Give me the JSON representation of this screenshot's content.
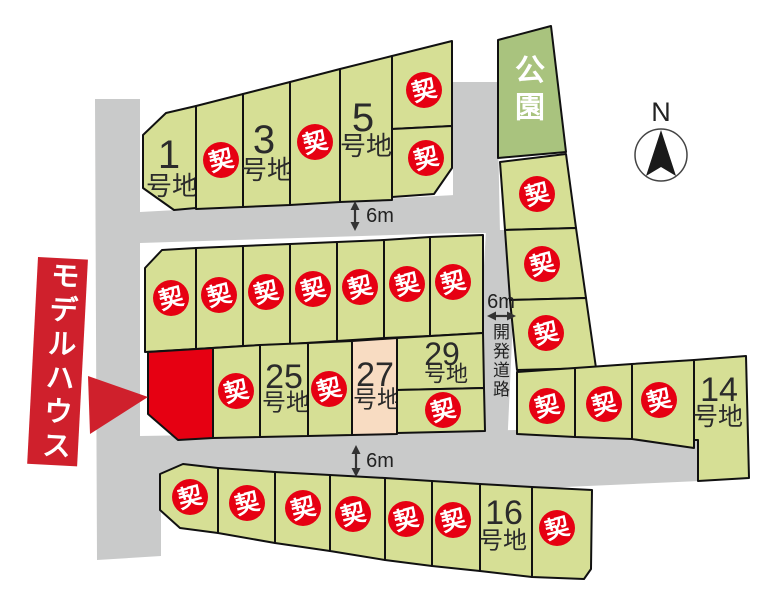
{
  "badge_label": "契",
  "park": {
    "label": "公園"
  },
  "road": {
    "label": "開発道路"
  },
  "model_house": {
    "label": "モデルハウス"
  },
  "north": {
    "label": "N"
  },
  "dims": [
    "6m",
    "6m",
    "6m"
  ],
  "colors": {
    "lot_green": "#d6df95",
    "park_green": "#a9c37e",
    "reserved_pink": "#f8dcc2",
    "sold_red": "#e60012",
    "model_red": "#e60012",
    "banner_red": "#cf202c",
    "road_gray": "#c9caca",
    "line_dark": "#111111",
    "text_dark": "#2b2b2b",
    "dim_color": "#333333"
  },
  "lots": [
    {
      "id": "t1",
      "number": "1",
      "suffix": "号地",
      "status": "available"
    },
    {
      "id": "t2",
      "status": "sold"
    },
    {
      "id": "t3",
      "number": "3",
      "suffix": "号地",
      "status": "available"
    },
    {
      "id": "t4",
      "status": "sold"
    },
    {
      "id": "t5",
      "number": "5",
      "suffix": "号地",
      "status": "available"
    },
    {
      "id": "t6",
      "status": "sold"
    },
    {
      "id": "t7",
      "status": "sold"
    },
    {
      "id": "park",
      "status": "park"
    },
    {
      "id": "s1",
      "status": "sold"
    },
    {
      "id": "s2",
      "status": "sold"
    },
    {
      "id": "s3",
      "status": "sold"
    },
    {
      "id": "r1",
      "status": "sold"
    },
    {
      "id": "r2",
      "status": "sold"
    },
    {
      "id": "r3",
      "status": "sold"
    },
    {
      "id": "l14",
      "number": "14",
      "suffix": "号地",
      "status": "available"
    },
    {
      "id": "m1",
      "status": "sold"
    },
    {
      "id": "m2",
      "status": "sold"
    },
    {
      "id": "m3",
      "status": "sold"
    },
    {
      "id": "m4",
      "status": "sold"
    },
    {
      "id": "m5",
      "status": "sold"
    },
    {
      "id": "m6",
      "status": "sold"
    },
    {
      "id": "m7",
      "status": "sold"
    },
    {
      "id": "model",
      "status": "model"
    },
    {
      "id": "mb1",
      "status": "sold"
    },
    {
      "id": "m25",
      "number": "25",
      "suffix": "号地",
      "status": "available"
    },
    {
      "id": "mb2",
      "status": "sold"
    },
    {
      "id": "m27",
      "number": "27",
      "suffix": "号地",
      "status": "reserved"
    },
    {
      "id": "m29",
      "number": "29",
      "suffix": "号地",
      "status": "available"
    },
    {
      "id": "mb3",
      "status": "sold"
    },
    {
      "id": "b1",
      "status": "sold"
    },
    {
      "id": "b2",
      "status": "sold"
    },
    {
      "id": "b3",
      "status": "sold"
    },
    {
      "id": "b4",
      "status": "sold"
    },
    {
      "id": "b5",
      "status": "sold"
    },
    {
      "id": "b6",
      "status": "sold"
    },
    {
      "id": "b16",
      "number": "16",
      "suffix": "号地",
      "status": "available"
    },
    {
      "id": "b8",
      "status": "sold"
    }
  ]
}
